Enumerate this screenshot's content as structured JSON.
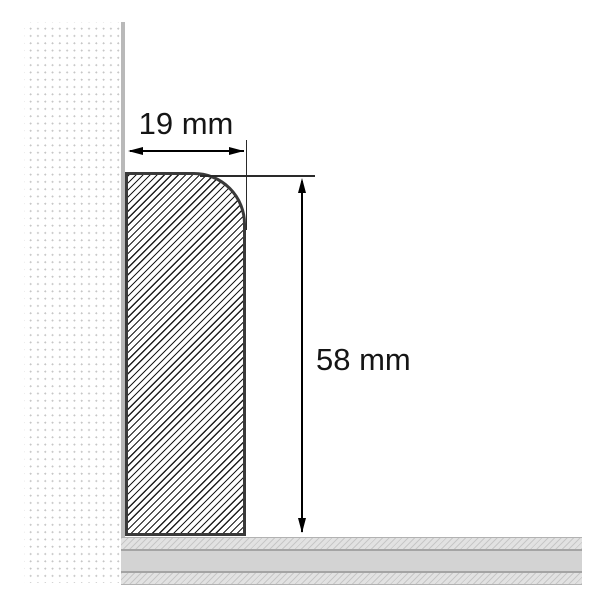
{
  "diagram": {
    "kind": "skirting-board-profile-cross-section",
    "dimension_width": {
      "label": "19 mm",
      "value": 19,
      "unit": "mm"
    },
    "dimension_height": {
      "label": "58 mm",
      "value": 58,
      "unit": "mm"
    },
    "colors": {
      "background": "#ffffff",
      "profile_outline": "#3a3a3a",
      "profile_hatch": "#1e1e1e",
      "wall_dots": "#c6c6c6",
      "wall_surface_line": "#b9b9b9",
      "floor_band": "#d3d3d3",
      "floor_hatch": "#c7c7c7",
      "floor_edge_line": "#a4a4a4",
      "dimension_line": "#000000",
      "label_text": "#151515"
    }
  }
}
